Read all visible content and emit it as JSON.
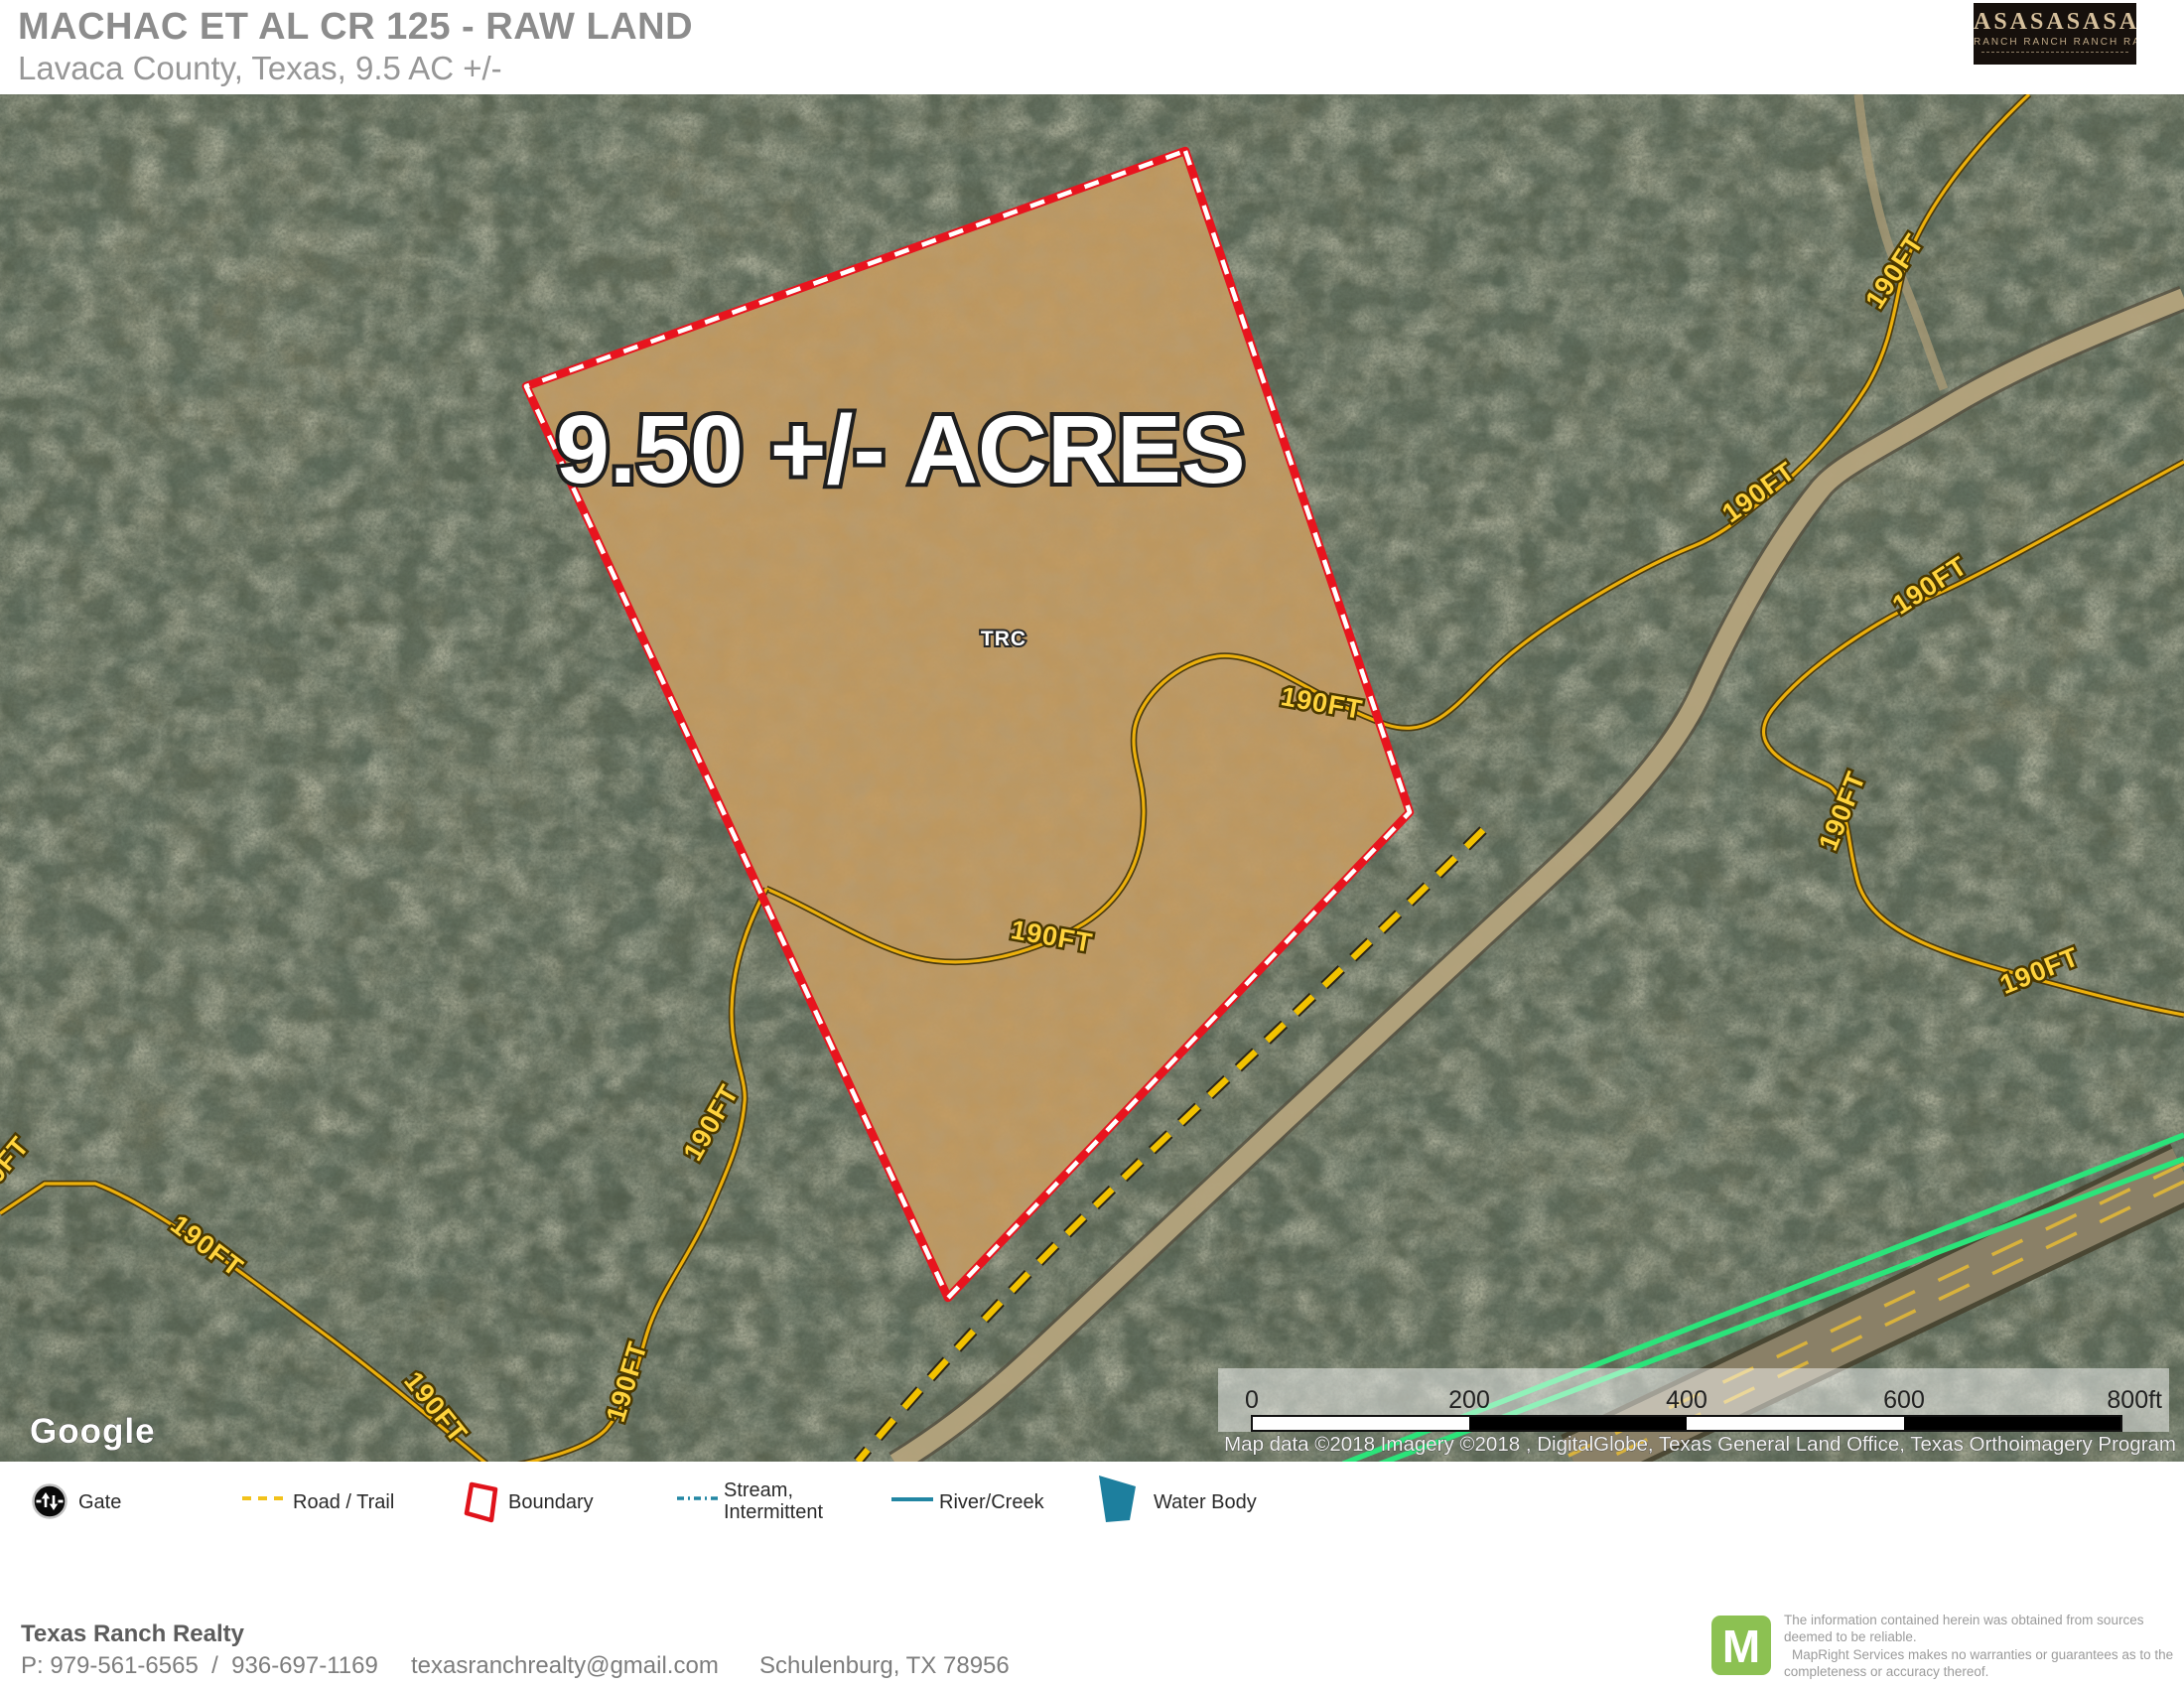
{
  "header": {
    "title": "MACHAC ET AL CR 125 - RAW LAND",
    "subtitle": "Lavaca County, Texas, 9.5 AC +/-",
    "logo": {
      "row1": "ASASASASA",
      "row2": "RANCH RANCH RANCH RANCH"
    }
  },
  "map": {
    "acres_label": "9.50 +/- ACRES",
    "tract_label": "TRC",
    "contour_label": "190FT",
    "google_logo": "Google",
    "attribution": "Map data ©2018  Imagery ©2018 , DigitalGlobe, Texas General Land Office, Texas Orthoimagery Program",
    "scalebar": {
      "ticks": [
        "0",
        "200",
        "400",
        "600",
        "800ft"
      ]
    },
    "colors": {
      "boundary_red": "#e8141e",
      "parcel_tan": "#c49b61",
      "contour_gold": "#ecb00c",
      "road_trail_yellow": "#f2c200",
      "water_teal": "#1d7f9e",
      "green_line": "#2be47a",
      "mapright_green": "#8cc152"
    }
  },
  "legend": {
    "items": [
      {
        "label": "Gate"
      },
      {
        "label": "Road / Trail"
      },
      {
        "label": "Boundary"
      },
      {
        "label_line1": "Stream,",
        "label_line2": "Intermittent"
      },
      {
        "label": "River/Creek"
      },
      {
        "label": "Water Body"
      }
    ]
  },
  "footer": {
    "company": "Texas Ranch Realty",
    "phone": "P: 979-561-6565  /  936-697-1169",
    "email": "texasranchrealty@gmail.com",
    "address": "Schulenburg, TX 78956"
  },
  "disclaimer": {
    "logo_letter": "M",
    "line1": "The information contained herein was obtained from sources deemed to be reliable.",
    "line2": "MapRight Services makes no warranties or guarantees as to the completeness or accuracy thereof."
  }
}
